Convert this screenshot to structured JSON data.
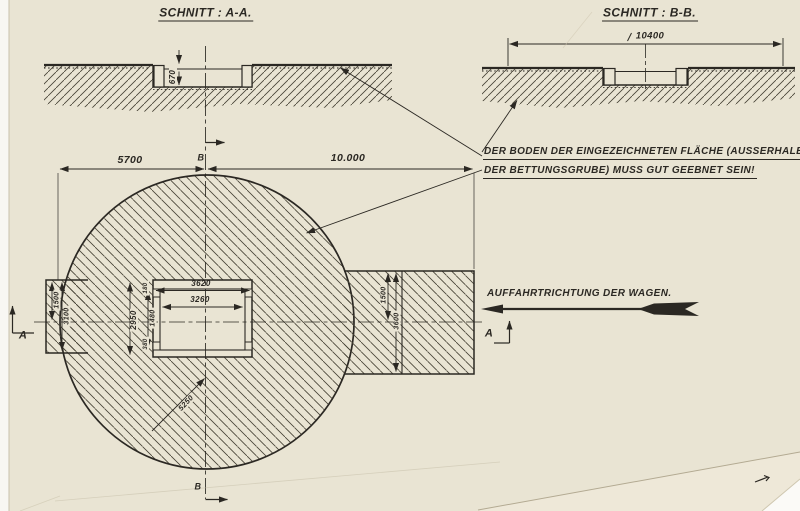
{
  "colors": {
    "paper": "#e9e4d3",
    "ink": "#2b2823",
    "backing": "#f8f7f3"
  },
  "titles": {
    "section_a": "SCHNITT : A-A.",
    "section_b": "SCHNITT : B-B."
  },
  "note": {
    "line1": "DER BODEN DER EINGEZEICHNETEN FLÄCHE (AUSSERHALB",
    "line2": "DER BETTUNGSGRUBE) MUSS GUT GEEBNET SEIN!"
  },
  "direction_label": "AUFFAHRTRICHTUNG DER WAGEN.",
  "dimensions": {
    "section_a_depth": "670",
    "section_b_width": "10400",
    "plan_left_span": "5700",
    "plan_right_span": "10.000",
    "pit_outer_width": "3620",
    "pit_inner_width": "3260",
    "pit_outer_height": "2950",
    "pit_inner_height": "1480",
    "pit_step_top": "180",
    "pit_step_bottom": "380",
    "left_strip_upper": "1500",
    "left_strip_height": "3100",
    "right_strip_upper": "1500",
    "right_strip_height": "3600",
    "circle_radius": "5250"
  },
  "markers": {
    "section_a": "A",
    "section_b": "B"
  }
}
